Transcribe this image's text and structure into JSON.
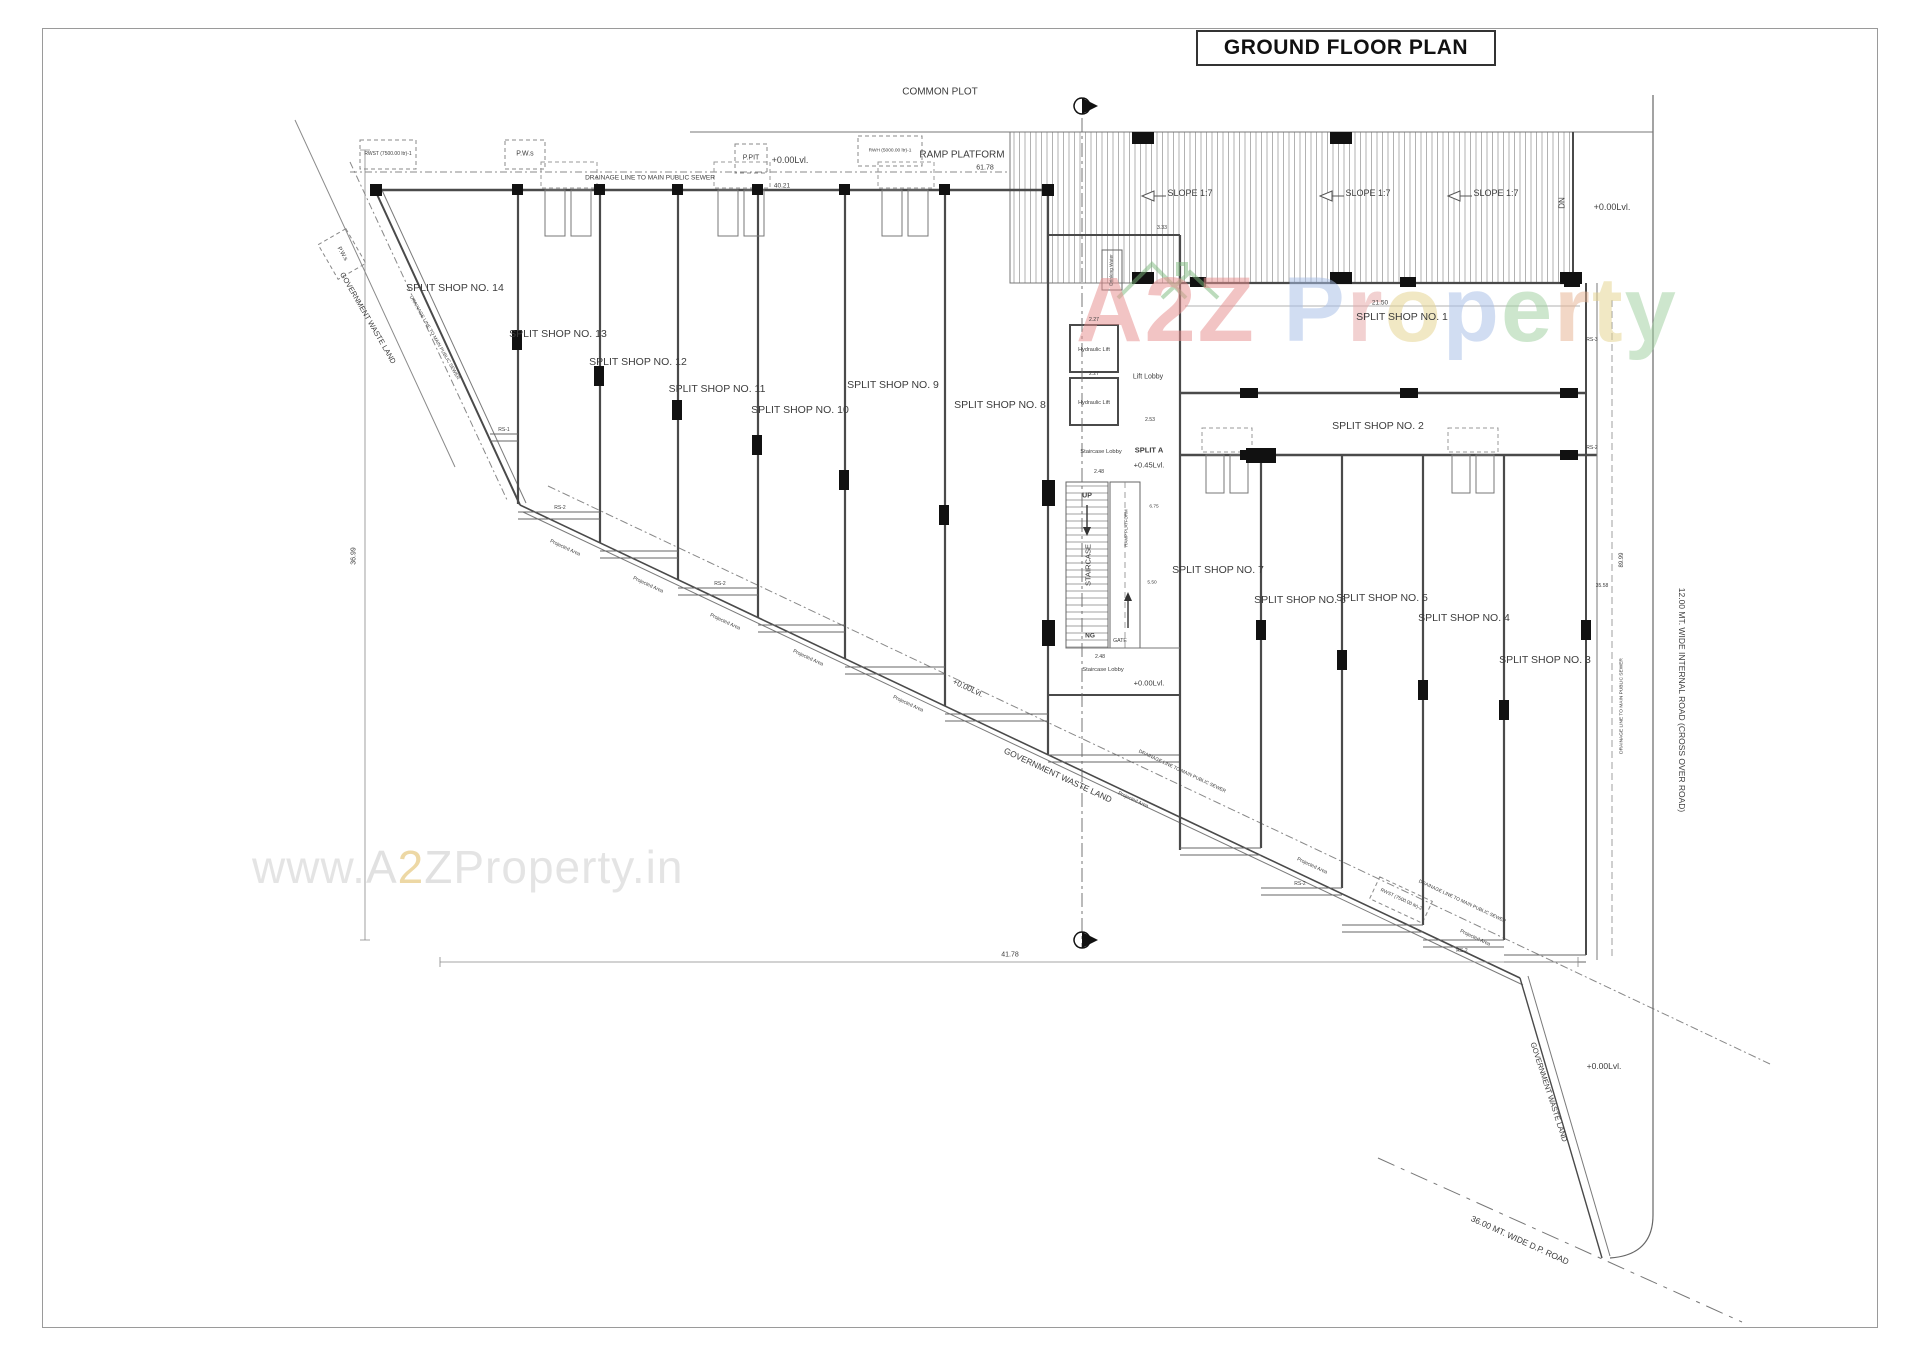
{
  "title": "GROUND FLOOR PLAN",
  "watermark": {
    "letters": [
      {
        "ch": "A",
        "color": "#e89090"
      },
      {
        "ch": "2",
        "color": "#e89090"
      },
      {
        "ch": "Z",
        "color": "#e89090"
      },
      {
        "ch": " ",
        "color": "#ffffff"
      },
      {
        "ch": "P",
        "color": "#a8bfe8"
      },
      {
        "ch": "r",
        "color": "#e8a8a8"
      },
      {
        "ch": "o",
        "color": "#e6d490"
      },
      {
        "ch": "p",
        "color": "#a8bfe8"
      },
      {
        "ch": "e",
        "color": "#a0d0a0"
      },
      {
        "ch": "r",
        "color": "#e8b494"
      },
      {
        "ch": "t",
        "color": "#e6d490"
      },
      {
        "ch": "y",
        "color": "#a0d0a0"
      }
    ],
    "house_icon_color": "#7cb87c",
    "url_letters": [
      {
        "ch": "w",
        "color": "#e2e2e2"
      },
      {
        "ch": "w",
        "color": "#e2e2e2"
      },
      {
        "ch": "w",
        "color": "#e2e2e2"
      },
      {
        "ch": ".",
        "color": "#e2e2e2"
      },
      {
        "ch": "A",
        "color": "#dedede"
      },
      {
        "ch": "2",
        "color": "#ecd49c"
      },
      {
        "ch": "Z",
        "color": "#dedede"
      },
      {
        "ch": "P",
        "color": "#e2e2e2"
      },
      {
        "ch": "r",
        "color": "#e2e2e2"
      },
      {
        "ch": "o",
        "color": "#e2e2e2"
      },
      {
        "ch": "p",
        "color": "#e2e2e2"
      },
      {
        "ch": "e",
        "color": "#e2e2e2"
      },
      {
        "ch": "r",
        "color": "#e2e2e2"
      },
      {
        "ch": "t",
        "color": "#e2e2e2"
      },
      {
        "ch": "y",
        "color": "#e2e2e2"
      },
      {
        "ch": ".",
        "color": "#e2e2e2"
      },
      {
        "ch": "i",
        "color": "#e2e2e2"
      },
      {
        "ch": "n",
        "color": "#e2e2e2"
      }
    ]
  },
  "labels": {
    "shops": [
      "SPLIT SHOP NO. 1",
      "SPLIT SHOP NO. 2",
      "SPLIT SHOP NO. 3",
      "SPLIT SHOP NO. 4",
      "SPLIT SHOP NO. 5",
      "SPLIT SHOP NO. 6",
      "SPLIT SHOP NO. 7",
      "SPLIT SHOP NO. 8",
      "SPLIT SHOP NO. 9",
      "SPLIT SHOP NO. 10",
      "SPLIT SHOP NO. 11",
      "SPLIT SHOP NO. 12",
      "SPLIT SHOP NO. 13",
      "SPLIT SHOP NO. 14"
    ],
    "common_plot": "COMMON PLOT",
    "ramp_platform": "RAMP PLATFORM",
    "slope": "SLOPE 1:7",
    "dn": "DN",
    "up": "UP",
    "ng": "NG",
    "gate": "GATE",
    "staircase": "STAIRCASE",
    "staircase_lobby": "Staircase Lobby",
    "lift_lobby": "Lift Lobby",
    "hydraulic": "Hydraulic Lift",
    "drinking": "Drinking Water",
    "split_a": "SPLIT A",
    "lvl000": "+0.00Lvl.",
    "lvl045": "+0.45Lvl.",
    "drainage": "DRAINAGE LINE TO MAIN PUBLIC SEWER",
    "gov_waste": "GOVERNMENT WASTE LAND",
    "projected": "Projected Area",
    "road12": "12.00 MT. WIDE INTERNAL ROAD (CROSS OVER ROAD)",
    "road36": "36.00 MT. WIDE D.P. ROAD",
    "rs1": "RS-1",
    "rs2": "RS-2",
    "rs3": "RS-3",
    "boxes": {
      "rwst1": "RWST (7500.00 ltr)-1",
      "rwst2": "RWST (7500.00 ltr)-2",
      "rwh": "RWH (5000.00 ltr)-1",
      "pws": "P.W.s",
      "ppit": "P.PIT"
    },
    "dims": {
      "d6178": "61.78",
      "d4021": "40.21",
      "d2150": "21.50",
      "d3699": "36.99",
      "d4178": "41.78",
      "d8999": "89.99",
      "d3558": "35.58",
      "d333": "3.33",
      "d227": "2.27",
      "d253": "2.53",
      "d248": "2.48",
      "d550": "5.50",
      "d675": "6.75"
    }
  }
}
